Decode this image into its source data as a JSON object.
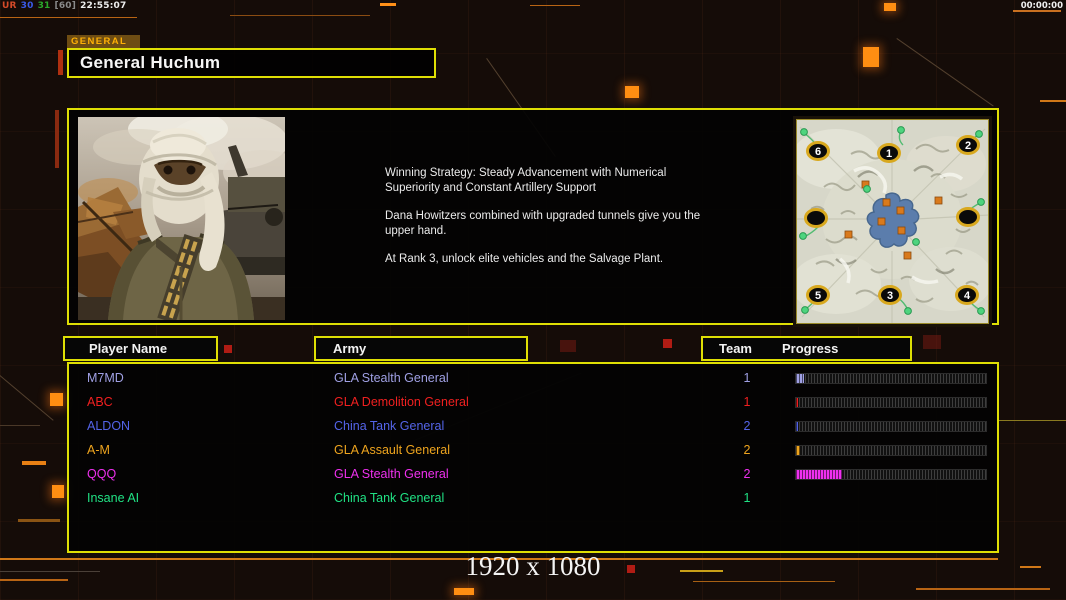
{
  "overlay": {
    "stats": [
      {
        "text": "UR",
        "color": "#d44a28"
      },
      {
        "text": "30",
        "color": "#3a5ae8"
      },
      {
        "text": "31",
        "color": "#2aa82a"
      },
      {
        "text": "[60]",
        "color": "#8a8a8a"
      },
      {
        "text": "22:55:07",
        "color": "#eeeeee"
      }
    ],
    "timer": "00:00:00"
  },
  "header": {
    "tab_label": "GENERAL",
    "title": "General Huchum"
  },
  "info": {
    "paragraphs": [
      "Winning Strategy: Steady Advancement with Numerical Superiority and Constant Artillery Support",
      "Dana Howitzers combined with upgraded tunnels give you the upper hand.",
      "At Rank 3, unlock elite vehicles and the Salvage Plant."
    ]
  },
  "map": {
    "positions": [
      {
        "label": "6"
      },
      {
        "label": "1"
      },
      {
        "label": "2"
      },
      {
        "label": ""
      },
      {
        "label": ""
      },
      {
        "label": "5"
      },
      {
        "label": "3"
      },
      {
        "label": "4"
      }
    ]
  },
  "table": {
    "headers": {
      "player": "Player Name",
      "army": "Army",
      "team": "Team",
      "progress": "Progress"
    },
    "rows": [
      {
        "name": "M7MD",
        "army": "GLA Stealth General",
        "team": "1",
        "color": "#a0a0e4",
        "progress": 4
      },
      {
        "name": "ABC",
        "army": "GLA Demolition General",
        "team": "1",
        "color": "#f02020",
        "progress": 1
      },
      {
        "name": "ALDON",
        "army": "China Tank General",
        "team": "2",
        "color": "#5464e8",
        "progress": 1
      },
      {
        "name": "A-M",
        "army": "GLA Assault General",
        "team": "2",
        "color": "#eea41e",
        "progress": 2
      },
      {
        "name": "QQQ",
        "army": "GLA Stealth General",
        "team": "2",
        "color": "#ee30ee",
        "progress": 24
      },
      {
        "name": "Insane AI",
        "army": "China Tank General",
        "team": "1",
        "color": "#20e284",
        "progress": null
      }
    ]
  },
  "footer": {
    "resolution": "1920 x 1080"
  }
}
